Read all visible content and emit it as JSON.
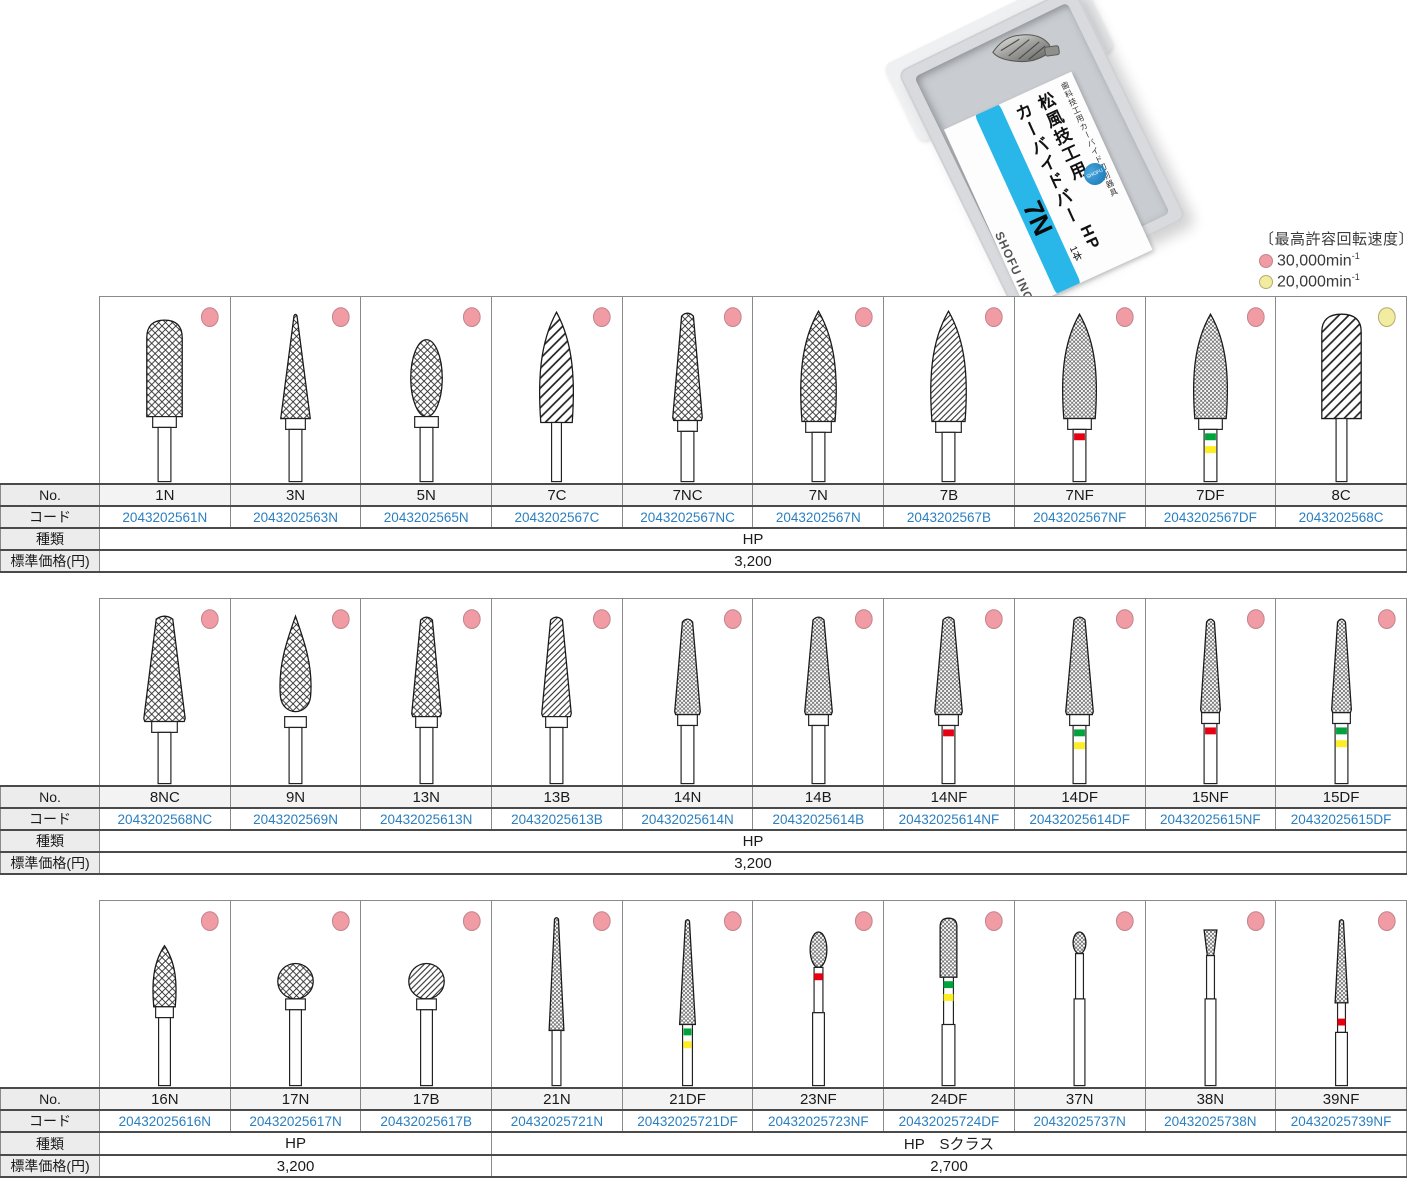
{
  "legend": {
    "title": "〔最高許容回転速度〕",
    "items": [
      {
        "dot": "pink",
        "label": "30,000min",
        "sup": "-1"
      },
      {
        "dot": "yellow",
        "label": "20,000min",
        "sup": "-1"
      }
    ]
  },
  "package": {
    "small_text": "歯科技工用カーバイド切削器具",
    "brand1": "松風技工用",
    "brand2": "カーバイドバー",
    "model": "7N",
    "type_label": "HP",
    "count_label": "1本",
    "company": "SHOFU INC."
  },
  "row_labels": {
    "no": "No.",
    "code": "コード",
    "kind": "種類",
    "price": "標準価格(円)"
  },
  "colors": {
    "dot_pink": "#f19ca5",
    "dot_pink_edge": "#c2848d",
    "dot_yellow": "#f2eca0",
    "dot_yellow_edge": "#b5ab6e",
    "band_red": "#e60012",
    "band_green": "#00a23c",
    "band_yellow": "#fdee21",
    "code_blue": "#2a7fc1",
    "stripe_cyan": "#29b7e9"
  },
  "tables": [
    {
      "products": [
        {
          "no": "1N",
          "code": "2043202561N",
          "dot": "pink",
          "bur": {
            "shape": "dome",
            "pattern": "cross",
            "w": 36,
            "h": 98,
            "top": 22,
            "shank": "hp",
            "collar": 24,
            "bands": []
          }
        },
        {
          "no": "3N",
          "code": "2043202563N",
          "dot": "pink",
          "bur": {
            "shape": "cone",
            "pattern": "cross",
            "w": 30,
            "h": 106,
            "top": 16,
            "shank": "hp",
            "collar": 20,
            "bands": []
          }
        },
        {
          "no": "5N",
          "code": "2043202565N",
          "dot": "pink",
          "bur": {
            "shape": "egg",
            "pattern": "cross",
            "w": 32,
            "h": 78,
            "top": 42,
            "shank": "hp",
            "collar": 24,
            "bands": []
          }
        },
        {
          "no": "7C",
          "code": "2043202567C",
          "dot": "pink",
          "bur": {
            "shape": "flame",
            "pattern": "coarse",
            "w": 38,
            "h": 112,
            "top": 14,
            "shank": "straight",
            "sw": 10,
            "bands": []
          }
        },
        {
          "no": "7NC",
          "code": "2043202567NC",
          "dot": "pink",
          "bur": {
            "shape": "taper",
            "pattern": "cross",
            "w": 30,
            "h": 110,
            "top": 14,
            "shank": "hp",
            "collar": 20,
            "bands": []
          }
        },
        {
          "no": "7N",
          "code": "2043202567N",
          "dot": "pink",
          "bur": {
            "shape": "flame",
            "pattern": "cross",
            "w": 40,
            "h": 112,
            "top": 13,
            "shank": "hp",
            "collar": 26,
            "bands": []
          }
        },
        {
          "no": "7B",
          "code": "2043202567B",
          "dot": "pink",
          "bur": {
            "shape": "flame",
            "pattern": "diag",
            "w": 40,
            "h": 112,
            "top": 13,
            "shank": "hp",
            "collar": 26,
            "bands": []
          }
        },
        {
          "no": "7NF",
          "code": "2043202567NF",
          "dot": "pink",
          "bur": {
            "shape": "flame",
            "pattern": "fine",
            "w": 38,
            "h": 106,
            "top": 16,
            "shank": "hp",
            "collar": 24,
            "bands": [
              "red"
            ]
          }
        },
        {
          "no": "7DF",
          "code": "2043202567DF",
          "dot": "pink",
          "bur": {
            "shape": "flame",
            "pattern": "fine",
            "w": 38,
            "h": 106,
            "top": 16,
            "shank": "hp",
            "collar": 24,
            "bands": [
              "green",
              "yellow"
            ]
          }
        },
        {
          "no": "8C",
          "code": "2043202568C",
          "dot": "yellow",
          "bur": {
            "shape": "dome",
            "pattern": "coarse",
            "w": 40,
            "h": 106,
            "top": 16,
            "shank": "straight",
            "sw": 11,
            "bands": []
          }
        }
      ],
      "kind_spans": [
        {
          "cols": 10,
          "label": "HP"
        }
      ],
      "price_spans": [
        {
          "cols": 10,
          "label": "3,200"
        }
      ]
    },
    {
      "products": [
        {
          "no": "8NC",
          "code": "2043202568NC",
          "dot": "pink",
          "bur": {
            "shape": "taper",
            "pattern": "cross",
            "w": 42,
            "h": 108,
            "top": 15,
            "shank": "hp",
            "collar": 26,
            "bands": []
          }
        },
        {
          "no": "9N",
          "code": "2043202569N",
          "dot": "pink",
          "bur": {
            "shape": "bud",
            "pattern": "cross",
            "w": 36,
            "h": 102,
            "top": 16,
            "shank": "hp",
            "collar": 22,
            "bands": []
          }
        },
        {
          "no": "13N",
          "code": "20432025613N",
          "dot": "pink",
          "bur": {
            "shape": "taper",
            "pattern": "cross",
            "w": 30,
            "h": 102,
            "top": 16,
            "shank": "hp",
            "collar": 22,
            "bands": []
          }
        },
        {
          "no": "13B",
          "code": "20432025613B",
          "dot": "pink",
          "bur": {
            "shape": "taper",
            "pattern": "diag",
            "w": 30,
            "h": 102,
            "top": 16,
            "shank": "hp",
            "collar": 22,
            "bands": []
          }
        },
        {
          "no": "14N",
          "code": "20432025614N",
          "dot": "pink",
          "bur": {
            "shape": "taper",
            "pattern": "fine",
            "w": 26,
            "h": 98,
            "top": 18,
            "shank": "hp",
            "collar": 20,
            "bands": []
          }
        },
        {
          "no": "14B",
          "code": "20432025614B",
          "dot": "pink",
          "bur": {
            "shape": "taper",
            "pattern": "fine",
            "w": 28,
            "h": 100,
            "top": 16,
            "shank": "hp",
            "collar": 20,
            "bands": []
          }
        },
        {
          "no": "14NF",
          "code": "20432025614NF",
          "dot": "pink",
          "bur": {
            "shape": "taper",
            "pattern": "fine",
            "w": 28,
            "h": 100,
            "top": 16,
            "shank": "hp",
            "collar": 20,
            "bands": [
              "red"
            ]
          }
        },
        {
          "no": "14DF",
          "code": "20432025614DF",
          "dot": "pink",
          "bur": {
            "shape": "taper",
            "pattern": "fine",
            "w": 28,
            "h": 100,
            "top": 16,
            "shank": "hp",
            "collar": 20,
            "bands": [
              "green",
              "yellow"
            ]
          }
        },
        {
          "no": "15NF",
          "code": "20432025615NF",
          "dot": "pink",
          "bur": {
            "shape": "taper",
            "pattern": "fine",
            "w": 20,
            "h": 96,
            "top": 18,
            "shank": "hp",
            "collar": 18,
            "bands": [
              "red"
            ]
          }
        },
        {
          "no": "15DF",
          "code": "20432025615DF",
          "dot": "pink",
          "bur": {
            "shape": "taper",
            "pattern": "fine",
            "w": 20,
            "h": 96,
            "top": 18,
            "shank": "hp",
            "collar": 18,
            "bands": [
              "green",
              "yellow"
            ]
          }
        }
      ],
      "kind_spans": [
        {
          "cols": 10,
          "label": "HP"
        }
      ],
      "price_spans": [
        {
          "cols": 10,
          "label": "3,200"
        }
      ]
    },
    {
      "products": [
        {
          "no": "16N",
          "code": "20432025616N",
          "dot": "pink",
          "bur": {
            "shape": "flame",
            "pattern": "cross",
            "w": 26,
            "h": 62,
            "top": 44,
            "shank": "hp",
            "collar": 18,
            "sw": 12,
            "bands": []
          }
        },
        {
          "no": "17N",
          "code": "20432025617N",
          "dot": "pink",
          "bur": {
            "shape": "ball",
            "pattern": "cross",
            "w": 36,
            "h": 36,
            "top": 62,
            "shank": "hp",
            "collar": 20,
            "sw": 12,
            "bands": []
          }
        },
        {
          "no": "17B",
          "code": "20432025617B",
          "dot": "pink",
          "bur": {
            "shape": "ball",
            "pattern": "diag",
            "w": 36,
            "h": 36,
            "top": 62,
            "shank": "hp",
            "collar": 20,
            "sw": 12,
            "bands": []
          }
        },
        {
          "no": "21N",
          "code": "20432025721N",
          "dot": "pink",
          "bur": {
            "shape": "needle",
            "pattern": "fine",
            "w": 15,
            "h": 116,
            "top": 14,
            "shank": "straight",
            "sw": 9,
            "bands": []
          }
        },
        {
          "no": "21DF",
          "code": "20432025721DF",
          "dot": "pink",
          "bur": {
            "shape": "needle",
            "pattern": "fine",
            "w": 16,
            "h": 108,
            "top": 16,
            "shank": "straight",
            "sw": 10,
            "bands": [
              "green",
              "yellow"
            ]
          }
        },
        {
          "no": "23NF",
          "code": "20432025723NF",
          "dot": "pink",
          "bur": {
            "shape": "egg",
            "pattern": "fine",
            "w": 17,
            "h": 36,
            "top": 30,
            "shank": "fg",
            "step": 112,
            "neck": 9,
            "lower": 12,
            "bands": [
              "red"
            ],
            "bandY": 72
          }
        },
        {
          "no": "24DF",
          "code": "20432025724DF",
          "dot": "pink",
          "bur": {
            "shape": "dome",
            "pattern": "fine",
            "w": 17,
            "h": 60,
            "top": 16,
            "shank": "fg",
            "step": 124,
            "neck": 10,
            "lower": 13,
            "bands": [
              "green",
              "yellow"
            ],
            "bandY": 80
          }
        },
        {
          "no": "37N",
          "code": "20432025737N",
          "dot": "pink",
          "bur": {
            "shape": "egg",
            "pattern": "fine",
            "w": 13,
            "h": 22,
            "top": 30,
            "shank": "fg",
            "step": 98,
            "neck": 8,
            "lower": 11,
            "bands": []
          }
        },
        {
          "no": "38N",
          "code": "20432025738N",
          "dot": "pink",
          "bur": {
            "shape": "invcone",
            "pattern": "fine",
            "w": 13,
            "h": 26,
            "top": 28,
            "shank": "fg",
            "step": 98,
            "neck": 8,
            "lower": 11,
            "bands": []
          }
        },
        {
          "no": "39NF",
          "code": "20432025739NF",
          "dot": "pink",
          "bur": {
            "shape": "needle",
            "pattern": "fine",
            "w": 13,
            "h": 86,
            "top": 16,
            "shank": "fg",
            "step": 132,
            "neck": 8,
            "lower": 12,
            "bands": [
              "red"
            ],
            "bandY": 118
          }
        }
      ],
      "kind_spans": [
        {
          "cols": 3,
          "label": "HP"
        },
        {
          "cols": 7,
          "label": "HP　Sクラス"
        }
      ],
      "price_spans": [
        {
          "cols": 3,
          "label": "3,200"
        },
        {
          "cols": 7,
          "label": "2,700"
        }
      ]
    }
  ]
}
